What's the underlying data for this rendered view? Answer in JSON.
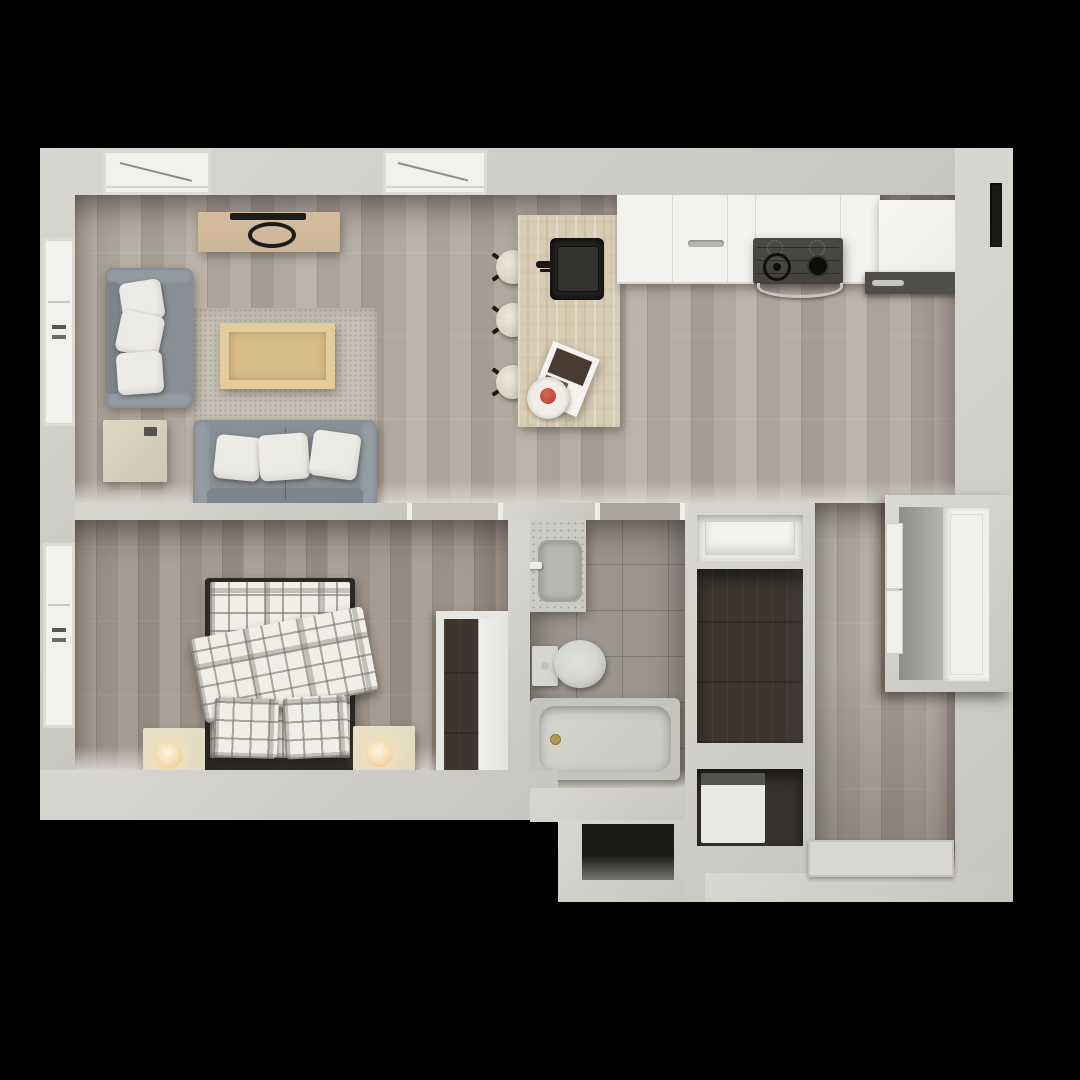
{
  "scene": {
    "kind": "3d-rendered floor plan, top-down view",
    "rooms": [
      {
        "name": "living-room",
        "furniture": [
          "tv-console",
          "tv",
          "loveseat",
          "throw-pillows",
          "side-table",
          "area-rug",
          "coffee-table",
          "sofa"
        ]
      },
      {
        "name": "kitchen",
        "furniture": [
          "stone-island",
          "island-sink",
          "faucet",
          "bar-stools",
          "magazine",
          "fruit-plate",
          "counter-cabinets",
          "gas-cooktop",
          "oven",
          "refrigerator",
          "under-counter-appliance"
        ]
      },
      {
        "name": "bedroom",
        "furniture": [
          "double-bed-plaid",
          "folded-duvet",
          "bed-pillows",
          "nightstand-left",
          "nightstand-right",
          "table-lamps",
          "wardrobe-closet"
        ]
      },
      {
        "name": "bathroom",
        "furniture": [
          "vanity-sink",
          "toilet",
          "bathtub"
        ]
      },
      {
        "name": "hall-entry",
        "furniture": [
          "shelf-niche",
          "walk-in-closet",
          "washer-closet",
          "entry-closet-unit",
          "entry-mat"
        ]
      }
    ],
    "windows": {
      "top_wall": 2,
      "left_wall": 2
    },
    "door_openings": [
      "bedroom",
      "bathroom"
    ],
    "bar_stool_count": 3
  },
  "colors": {
    "page_bg": "#000000",
    "wall": "#d0cfc9",
    "floor_main": "#b4aba0",
    "floor_bedroom": "#a79d92",
    "floor_bath": "#9b958d",
    "floor_closet": "#3c362f",
    "counter": "#f2f2ef",
    "island": "#d9ccb5",
    "sofa": "#878e94",
    "pillow": "#edebe5",
    "rug": "#c6c0b4",
    "console_wood": "#ccb698",
    "table_wood": "#e4cd9c",
    "bed_frame": "#2b2926",
    "plaid_base": "#f0eee8",
    "nightstand": "#e2d8c1",
    "lamp_glow": "#eed3a0",
    "fixture": "#d6d6d1",
    "appliance_dark": "#45433f",
    "accent_red": "#c14f3c",
    "mat": "#d8d7d1",
    "window_white": "#f1f1ee",
    "niche_dark": "#1b1a17"
  }
}
